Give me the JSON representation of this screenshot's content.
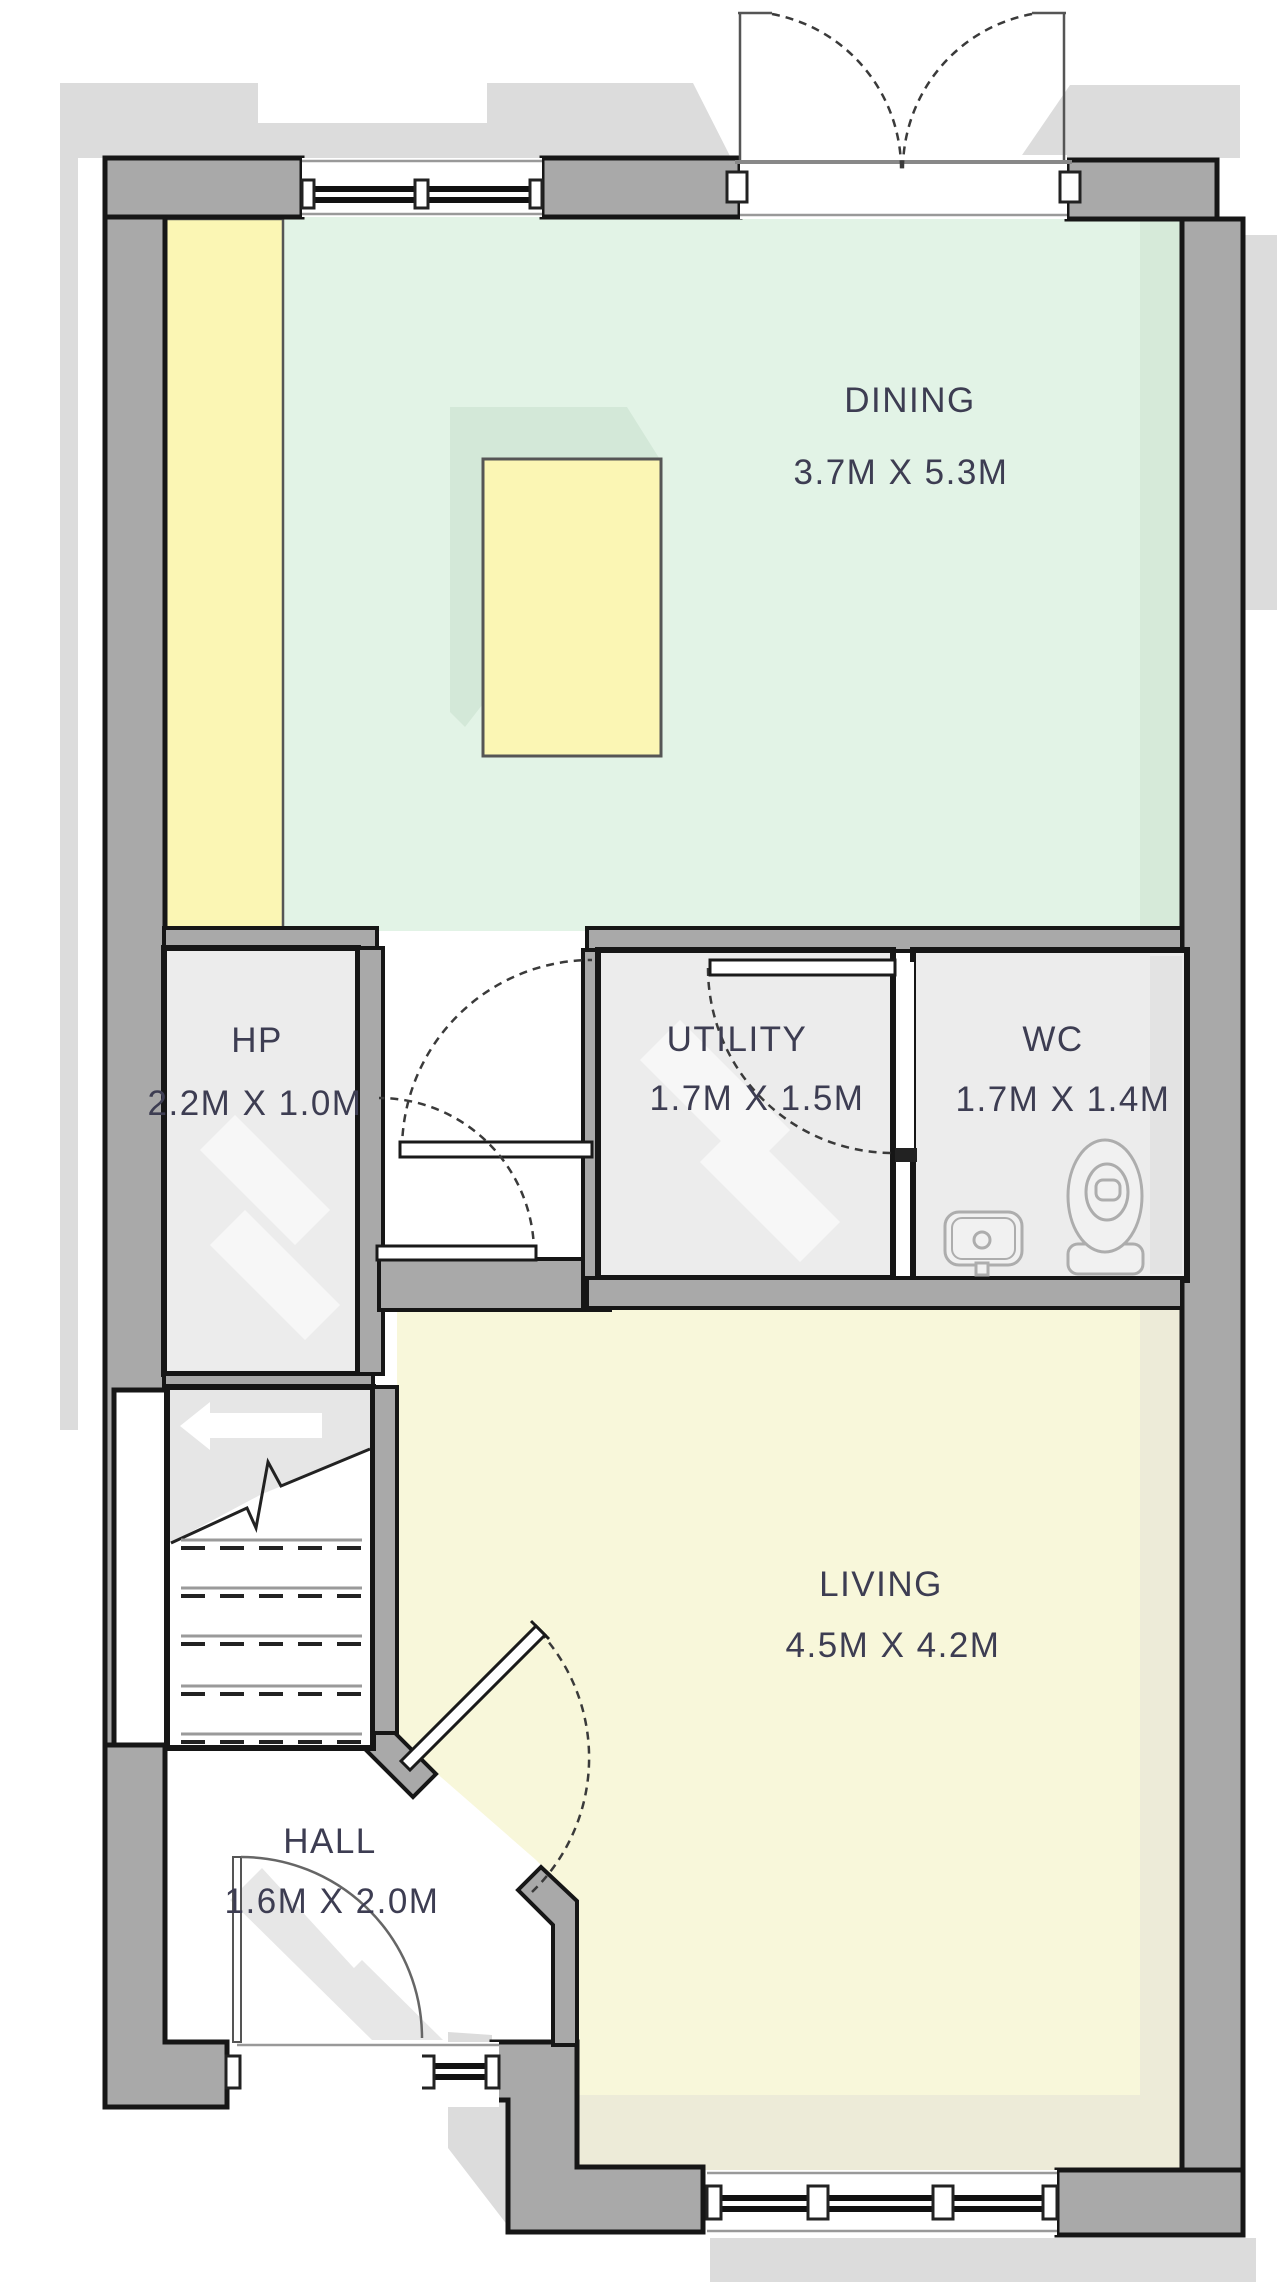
{
  "title": "Ground floor plan",
  "rooms": {
    "dining": {
      "name": "DINING",
      "dims": "3.7M X 5.3M"
    },
    "hp": {
      "name": "HP",
      "dims": "2.2M X 1.0M"
    },
    "utility": {
      "name": "UTILITY",
      "dims": "1.7M X 1.5M"
    },
    "wc": {
      "name": "WC",
      "dims": "1.7M X 1.4M"
    },
    "living": {
      "name": "LIVING",
      "dims": "4.5M X 4.2M"
    },
    "hall": {
      "name": "HALL",
      "dims": "1.6M X 2.0M"
    }
  },
  "colors": {
    "wall": "#a9a9a9",
    "dining_floor": "#e2f3e6",
    "dining_floor_shade": "#d6ead9",
    "living_floor": "#f8f7da",
    "living_floor_shade": "#edebd8",
    "service_floor": "#ececec",
    "accent_yellow": "#fbf6b4",
    "table_shadow": "#d3e8d8",
    "drop_shadow": "#dcdcdc",
    "label_text": "#3d3d52"
  },
  "icons": [
    "french-doors-icon",
    "window-icon",
    "door-swing-icon",
    "stairs-icon",
    "toilet-icon",
    "basin-icon"
  ]
}
